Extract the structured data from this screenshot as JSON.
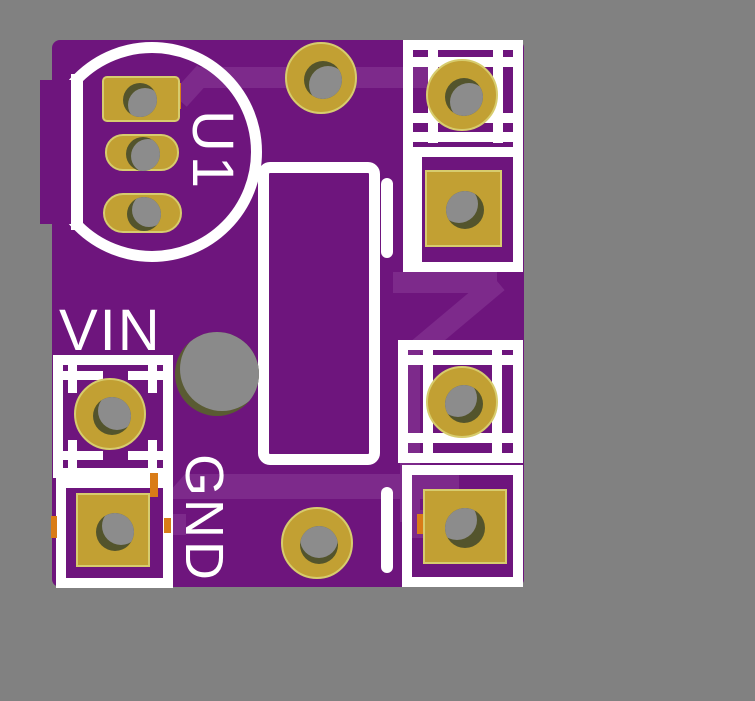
{
  "pcb": {
    "refdes": "U1",
    "labels": {
      "vin": "VIN",
      "gnd": "GND"
    }
  },
  "colors": {
    "bg": "#818181",
    "board": "#6E157D",
    "trace": "#7D2A8B",
    "silk": "#FFFFFF",
    "gold": "#C2A033",
    "rim": "#D7CC6D",
    "olive": "#53542C",
    "bore": "#8C8C8C",
    "orange": "#D97C17",
    "npth-olive": "#5A5B33",
    "npth-bore": "#8A8A8A"
  }
}
